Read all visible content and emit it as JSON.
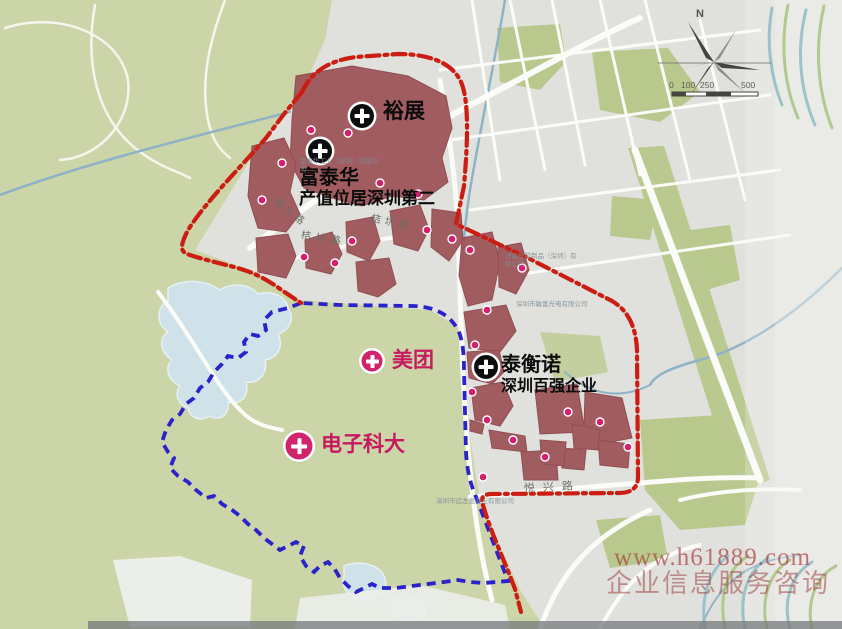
{
  "title": "industrial-zone-map",
  "colors": {
    "land_green": "#ccd5a8",
    "urban_grey": "#e0e1dd",
    "water_blue": "#cfe1e9",
    "factory_maroon": "#9d5257",
    "boundary_red": "#cc1d12",
    "boundary_blue": "#2a23cb",
    "marker_pink": "#d0246b",
    "label_pink": "#c6195f"
  },
  "landmarks": [
    {
      "label": "裕展",
      "marker": "black-cross"
    },
    {
      "label": "富泰华",
      "subtitle": "产值位居深圳第二",
      "marker": "black-cross"
    },
    {
      "label": "泰衡诺",
      "subtitle": "深圳百强企业",
      "marker": "black-cross"
    },
    {
      "label": "美团",
      "marker": "pink-cross"
    },
    {
      "label": "电子科大",
      "marker": "pink-cross"
    }
  ],
  "roads": [
    {
      "label": "观光路"
    },
    {
      "label": "桔坑路"
    },
    {
      "label": "桔坑路"
    },
    {
      "label": "悦兴路"
    }
  ],
  "companies": [
    {
      "label": "富泰华工业（深圳）有限公司"
    },
    {
      "label": "洋金塑胶制品（深圳）有限公司"
    },
    {
      "label": "深圳市敏富光电有限公司"
    },
    {
      "label": "深圳市远龙混凝土有限公司"
    }
  ],
  "compass": {
    "north_label": "N"
  },
  "scale_bar": {
    "ticks": [
      "0",
      "100",
      "250",
      "500"
    ]
  },
  "watermark": {
    "line1": "www.h61889.com",
    "line2": "企业信息服务咨询"
  }
}
